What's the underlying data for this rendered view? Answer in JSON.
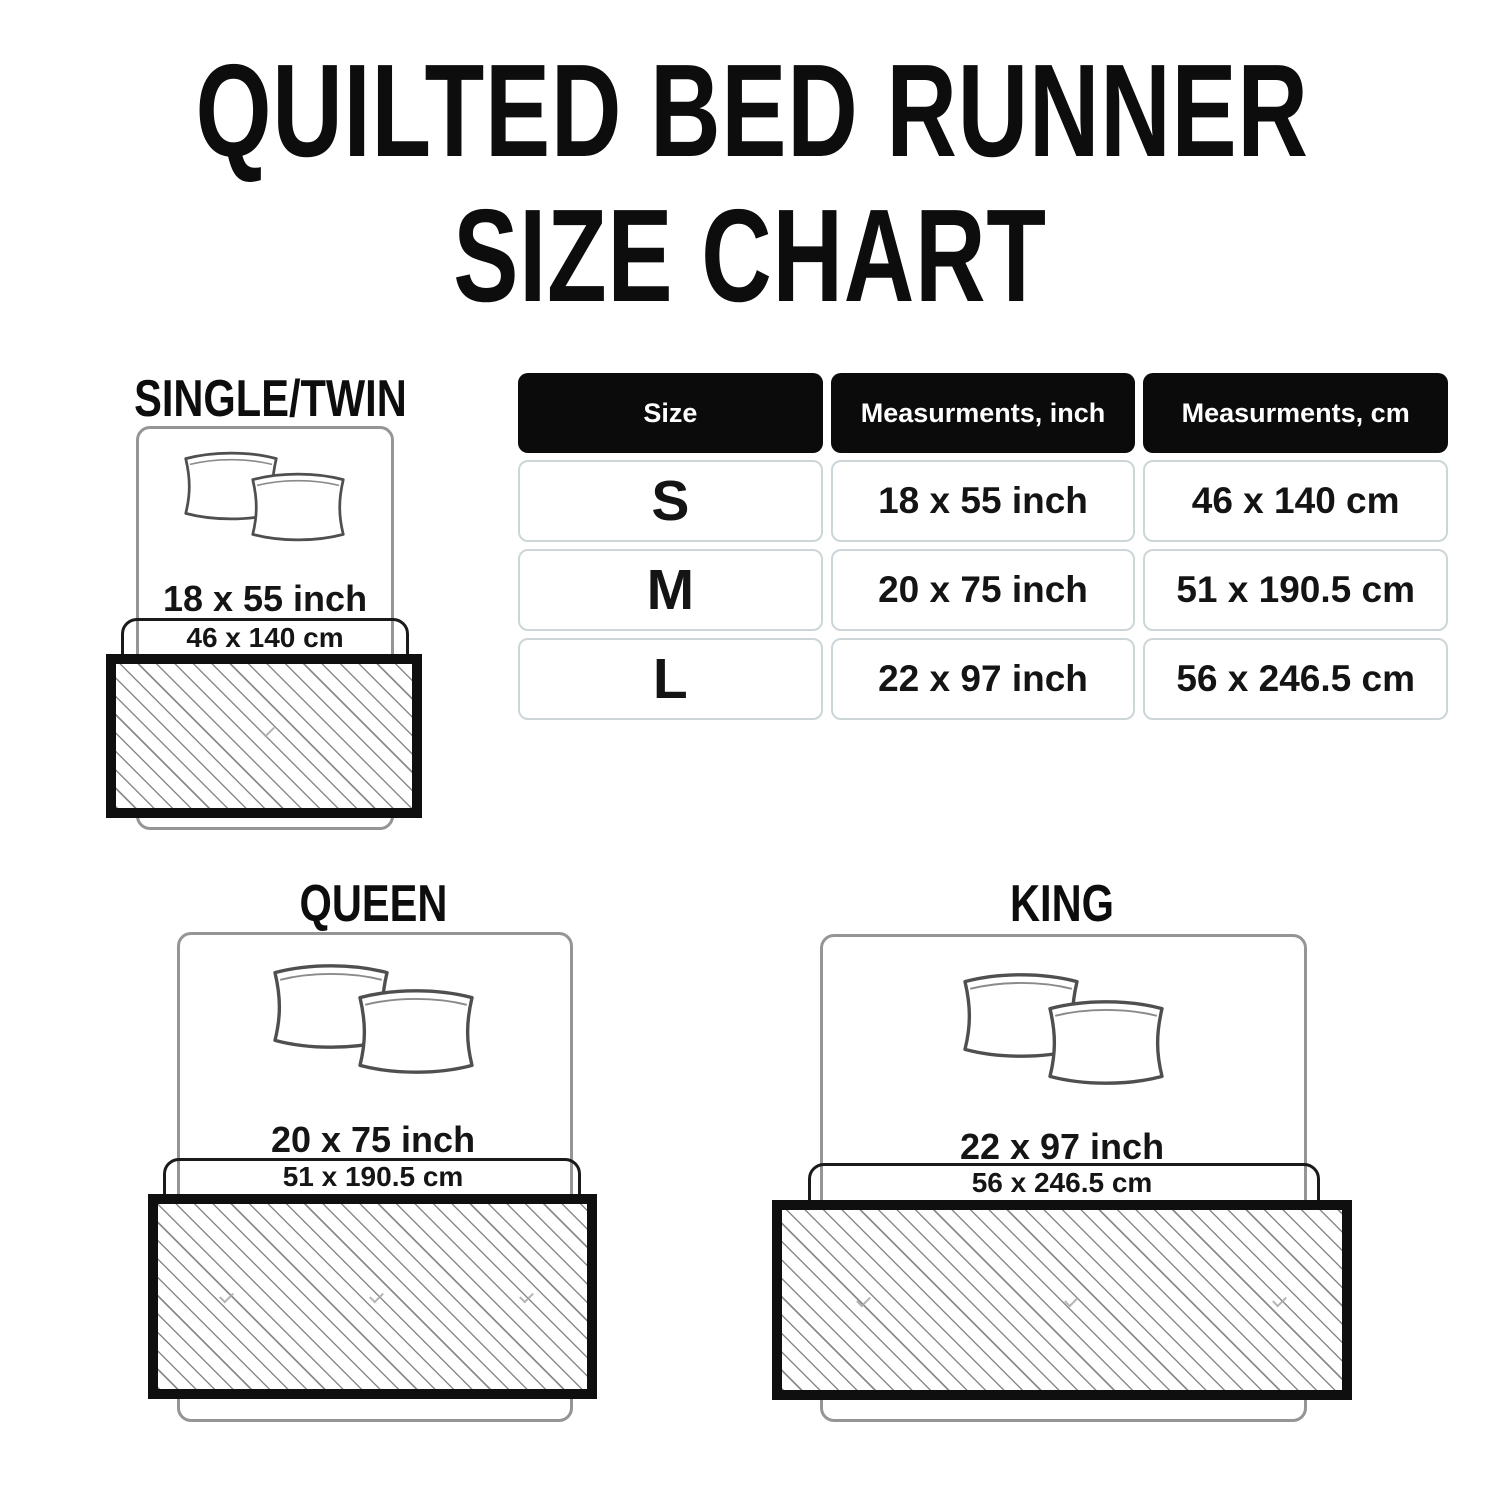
{
  "title": {
    "line1": "QUILTED BED RUNNER",
    "line2": "SIZE CHART"
  },
  "size_table": {
    "headers": {
      "size": "Size",
      "inch": "Measurments, inch",
      "cm": "Measurments, cm"
    },
    "rows": [
      {
        "size": "S",
        "inch": "18 x 55 inch",
        "cm": "46 x 140 cm"
      },
      {
        "size": "M",
        "inch": "20 x 75 inch",
        "cm": "51 x 190.5 cm"
      },
      {
        "size": "L",
        "inch": "22 x 97 inch",
        "cm": "56 x 246.5 cm"
      }
    ]
  },
  "diagrams": {
    "single_twin": {
      "label": "SINGLE/TWIN",
      "inch": "18 x 55 inch",
      "cm": "46 x 140 cm"
    },
    "queen": {
      "label": "QUEEN",
      "inch": "20 x 75 inch",
      "cm": "51 x 190.5 cm"
    },
    "king": {
      "label": "KING",
      "inch": "22 x 97 inch",
      "cm": "56 x 246.5 cm"
    }
  },
  "colors": {
    "background": "#ffffff",
    "text": "#111111",
    "table_header_bg": "#0b0b0b",
    "table_header_text": "#ffffff",
    "table_cell_border": "#ccd6d8",
    "bed_outline": "#959595",
    "runner_border": "#0f0f0f",
    "hatch_line": "#8b8b8b"
  }
}
